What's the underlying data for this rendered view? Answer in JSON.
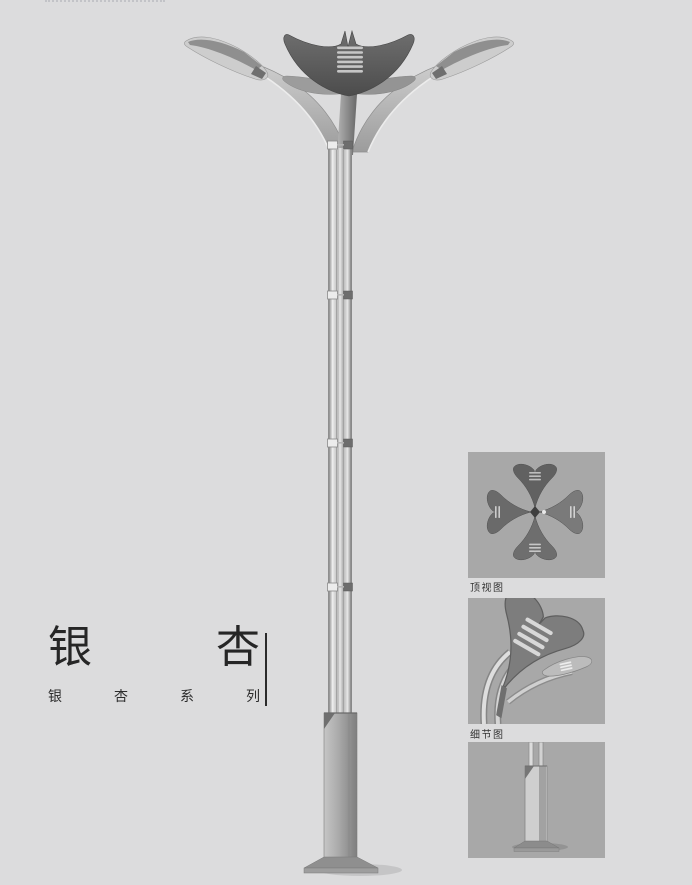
{
  "page": {
    "background_color": "#dcdcdd"
  },
  "branding": {
    "title": "银杏",
    "subtitle": "银杏系列"
  },
  "main_illustration": {
    "name": "ginkgo-double-arm-street-lamp"
  },
  "panels": [
    {
      "caption": "顶视图",
      "illustration": "lamp-top-view"
    },
    {
      "caption": "细节图",
      "illustration": "lamp-head-detail"
    },
    {
      "caption": "",
      "illustration": "lamp-pole-base"
    }
  ],
  "colors": {
    "page_background": "#dcdcdd",
    "panel_background": "#a8a8a8",
    "title_text": "#262626",
    "lamp_head_dark": "#5a5a5a",
    "pole_metal_light": "#d6d6d6",
    "base_gray": "#a0a0a0"
  }
}
